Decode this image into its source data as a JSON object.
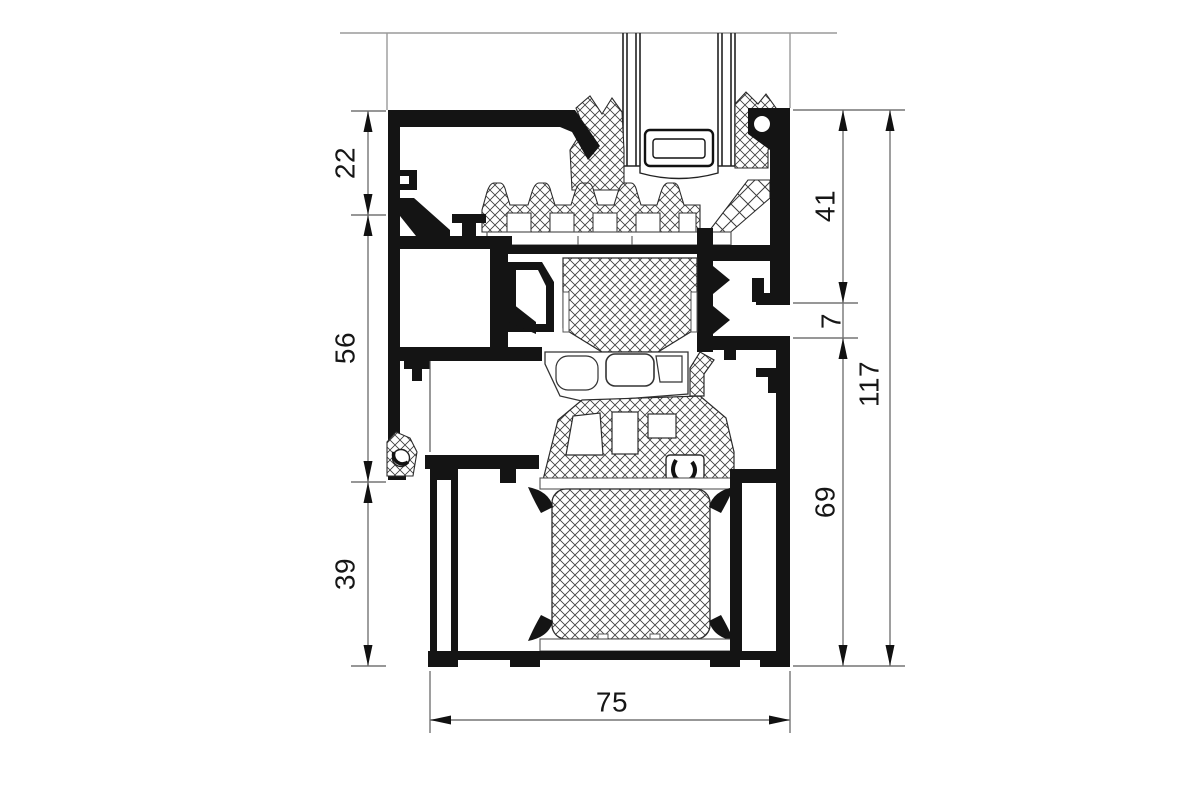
{
  "drawing": {
    "kind": "technical cross-section of aluminium window sill profile",
    "colors": {
      "ink": "#141414",
      "outline": "#2b2b2b",
      "dimension_line": "#757575",
      "background": "#ffffff"
    }
  },
  "dimensions": {
    "left_chain": [
      {
        "id": "dim-22",
        "value": "22"
      },
      {
        "id": "dim-56",
        "value": "56"
      },
      {
        "id": "dim-39",
        "value": "39"
      }
    ],
    "right_chain": [
      {
        "id": "dim-41",
        "value": "41"
      },
      {
        "id": "dim-7",
        "value": "7"
      },
      {
        "id": "dim-69",
        "value": "69"
      }
    ],
    "overall_height": {
      "id": "dim-117",
      "value": "117"
    },
    "overall_width": {
      "id": "dim-75",
      "value": "75"
    }
  }
}
